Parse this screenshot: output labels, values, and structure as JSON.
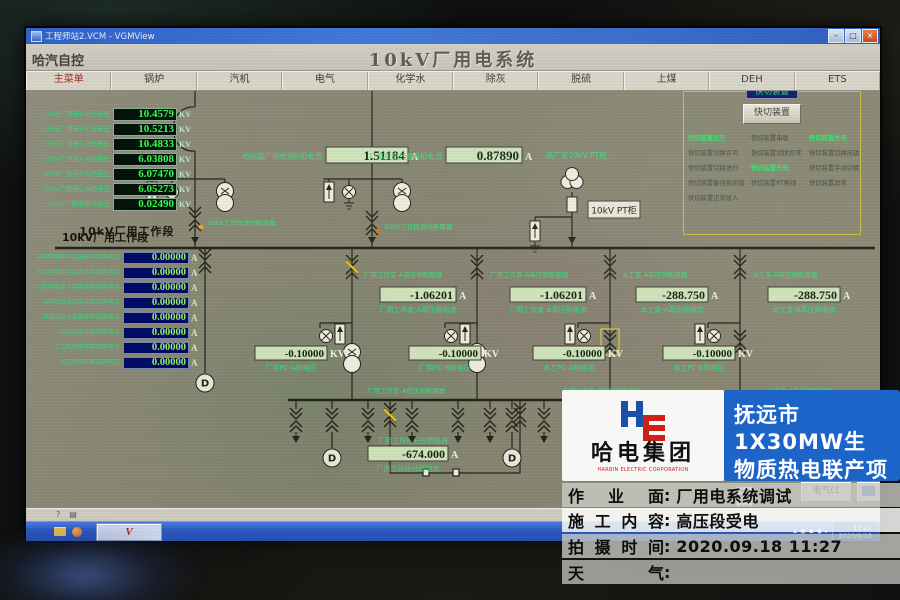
{
  "window": {
    "title": "工程师站2.VCM - VGMView",
    "min_label": "–",
    "max_label": "□",
    "close_label": "×"
  },
  "header": {
    "app_name": "哈汽自控",
    "page_title": "10kV厂用电系统"
  },
  "menu": {
    "items": [
      "主菜单",
      "锅炉",
      "汽机",
      "电气",
      "化学水",
      "除灰",
      "脱硫",
      "上煤",
      "DEH",
      "ETS"
    ]
  },
  "left_panel": {
    "unit": "KV",
    "rows": [
      {
        "label": "10kV厂用电A-B线电压",
        "value": "10.4579"
      },
      {
        "label": "10kV厂用电B-C线电压",
        "value": "10.5213"
      },
      {
        "label": "10kV厂用电C-A线电压",
        "value": "10.4833"
      },
      {
        "label": "10kV厂用电A-N相电压",
        "value": "6.03808"
      },
      {
        "label": "10kV厂用电B-N相电压",
        "value": "6.07470"
      },
      {
        "label": "10kV厂用电C-N相电压",
        "value": "6.05273"
      },
      {
        "label": "10kV厂用电零序电压",
        "value": "0.02490"
      }
    ]
  },
  "work_panel": {
    "title": "10kV厂用工作段",
    "unit": "A",
    "rows": [
      {
        "label": "A热网循环水泵高压柜回路电流",
        "value": "0.00000"
      },
      {
        "label": "B热网循环水泵高压柜回路电流",
        "value": "0.00000"
      },
      {
        "label": "C热网循环水泵高压柜回路电流",
        "value": "0.00000"
      },
      {
        "label": "A电动给水泵高压柜回路电流",
        "value": "0.00000"
      },
      {
        "label": "B电动给水泵高压柜回路电流",
        "value": "0.00000"
      },
      {
        "label": "一次风机高压柜回路电流",
        "value": "0.00000"
      },
      {
        "label": "二次风机高压柜回路电流",
        "value": "0.00000"
      },
      {
        "label": "引风机高压柜回路电流",
        "value": "0.00000"
      }
    ]
  },
  "fast_switch": {
    "title": "快切装置",
    "button_label": "快切装置",
    "statuses": [
      [
        {
          "label": "快切装置远方",
          "on": true
        },
        {
          "label": "快切装置串联",
          "on": false
        },
        {
          "label": "快切装置失电",
          "on": true
        }
      ],
      [
        {
          "label": "快切装置切换许可",
          "on": false
        },
        {
          "label": "快切装置切换异常",
          "on": false
        },
        {
          "label": "快切装置切换闭锁",
          "on": false
        }
      ],
      [
        {
          "label": "快切装置切换进行",
          "on": false
        },
        {
          "label": "快切装置失电",
          "on": true
        },
        {
          "label": "快切装置手动切换",
          "on": false
        }
      ],
      [
        {
          "label": "快切装置备自投闭锁",
          "on": false
        },
        {
          "label": "快切装置PT断线",
          "on": false
        },
        {
          "label": "快切装置异常",
          "on": false
        }
      ],
      [
        {
          "label": "快切装置正常投入",
          "on": false
        },
        null,
        null
      ]
    ]
  },
  "diagram": {
    "bus_label": "10kV厂用工作段",
    "pt_box_label": "10kV PT柜",
    "labels": [
      "10kV工作段进线断路器",
      "10kV工作段进线断路器",
      "厂用工作变-A高压侧断路器",
      "厂用工作变-B高压侧断路器",
      "水工变-A高压侧断路器",
      "水工变-B高压侧断路器",
      "厂用工作变-A低压侧断路器",
      "厂用工作变-B低压侧断路器",
      "水工变-A低压侧断路器",
      "厂用工作段分段断路器",
      "高厂变10kV PT柜"
    ],
    "measurements": [
      {
        "label": "电抗器厂用电侧B相电流",
        "value": "1.51184",
        "unit": "A"
      },
      {
        "label": "厂高变低压侧B相电流",
        "value": "0.87890",
        "unit": "A"
      },
      {
        "label": "厂用工作变-A高压侧电流",
        "value": "-1.06201",
        "unit": "A"
      },
      {
        "label": "厂用工作变-B高压侧电流",
        "value": "-1.06201",
        "unit": "A"
      },
      {
        "label": "水工变-A高压侧电流",
        "value": "-288.750",
        "unit": "A"
      },
      {
        "label": "水工变-B高压侧电流",
        "value": "-288.750",
        "unit": "A"
      },
      {
        "label": "厂用PC-A段电压",
        "value": "-0.10000",
        "unit": "KV"
      },
      {
        "label": "厂用PC-B段电压",
        "value": "-0.10000",
        "unit": "KV"
      },
      {
        "label": "水工PC-A段电压",
        "value": "-0.10000",
        "unit": "KV"
      },
      {
        "label": "水工PC-B段电压",
        "value": "-0.10000",
        "unit": "KV"
      },
      {
        "label": "厂用工作段分段电流",
        "value": "-674.000",
        "unit": "A"
      }
    ]
  },
  "overlay": {
    "company": "哈电集团",
    "company_en": "HARBIN ELECTRIC CORPORATION",
    "project_line1": "抚远市1X30MW生",
    "project_line2": "物质热电联产项目",
    "colon": ":",
    "rows": [
      {
        "label": "作业面",
        "value": "厂用电系统调试"
      },
      {
        "label": "施工内容",
        "value": "高压段受电"
      },
      {
        "label": "拍摄时间",
        "value": "2020.09.18 11:27"
      },
      {
        "label": "天气",
        "value": ""
      }
    ]
  },
  "status_strip": {
    "icons": [
      "?",
      "▤"
    ]
  },
  "taskbar": {
    "time": "11:22",
    "date": "2020/9/18",
    "chip1": "电气(1",
    "vbutton": "V",
    "tray_icons": [
      "▴",
      "◉",
      "▪",
      "◆",
      "▸"
    ]
  }
}
